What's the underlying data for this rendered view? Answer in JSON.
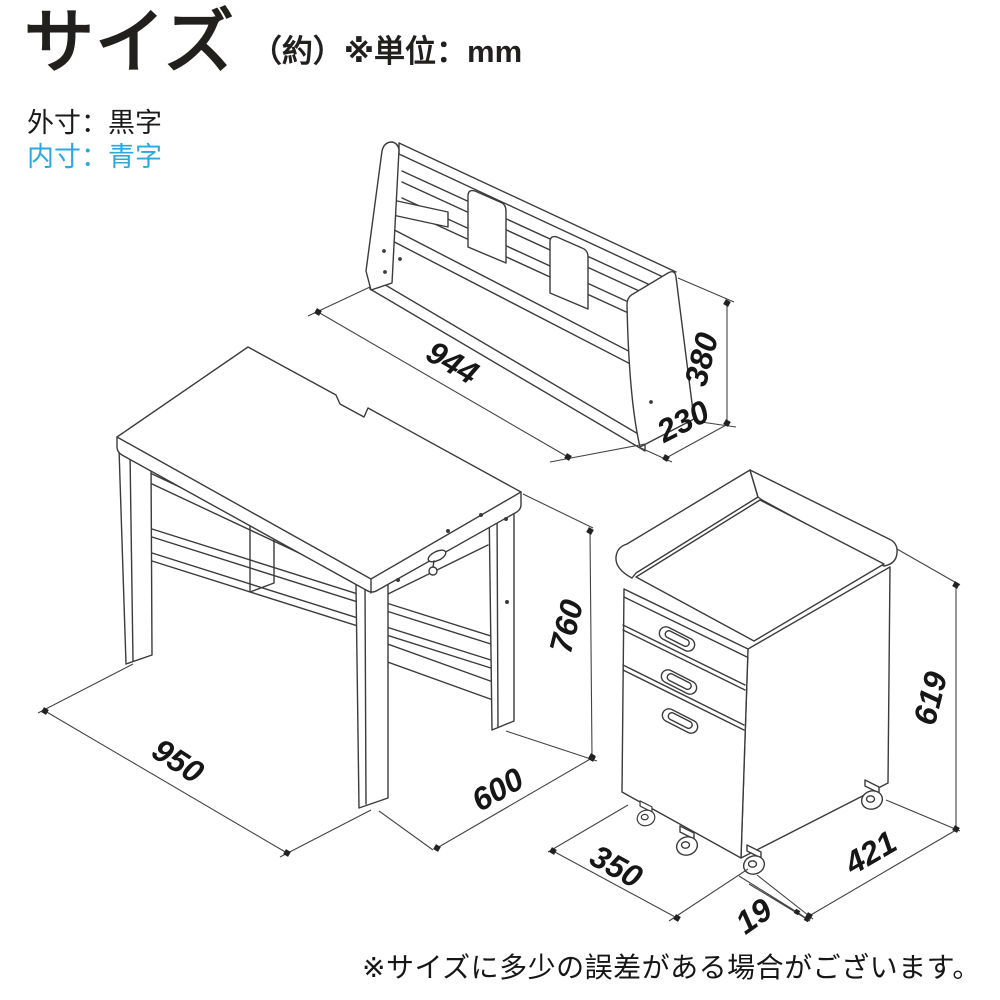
{
  "title": {
    "main": "サイズ",
    "qualifier": "（約）※単位：mm"
  },
  "legend": {
    "outer_label": "外寸：黒字",
    "inner_label": "内寸：青字"
  },
  "colors": {
    "outer_dim_text": "#1a1a1a",
    "inner_dim_text": "#29a9dc",
    "line": "#3b3b3b"
  },
  "figures": {
    "shelf_unit": {
      "width_mm": "944",
      "height_mm": "380",
      "depth_mm": "230"
    },
    "desk": {
      "width_mm": "950",
      "height_mm": "760",
      "depth_mm": "600"
    },
    "wagon": {
      "width_mm": "350",
      "height_mm": "619",
      "depth_mm": "421",
      "caster_mm": "19"
    }
  },
  "note": "※サイズに多少の誤差がある場合がございます。"
}
